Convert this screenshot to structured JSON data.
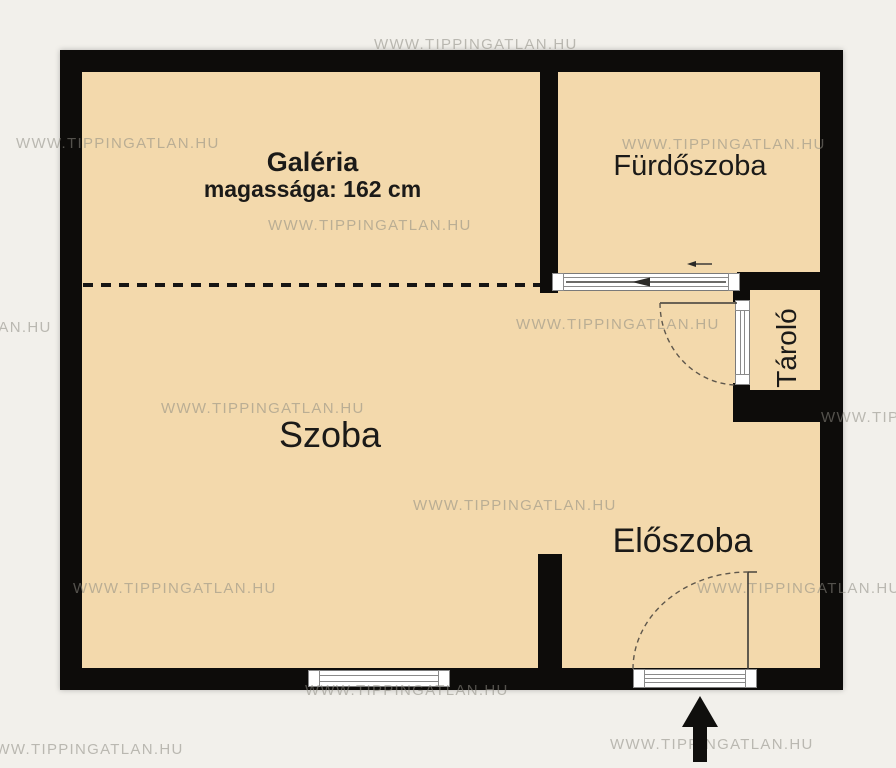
{
  "watermark": {
    "text": "WWW.TIPPINGATLAN.HU"
  },
  "rooms": {
    "galeria": {
      "name": "Galéria",
      "height_note": "magassága: 162 cm"
    },
    "furdoszoba": {
      "name": "Fürdőszoba"
    },
    "szoba": {
      "name": "Szoba"
    },
    "eloszoba": {
      "name": "Előszoba"
    },
    "tarolo": {
      "name": "Tároló"
    }
  },
  "colors": {
    "floor": "#f3d9ac",
    "wall": "#0d0c0a",
    "background": "#f2f0eb",
    "watermark": "#8d8b82"
  },
  "watermarks": [
    {
      "x": 374,
      "y": 36
    },
    {
      "x": 16,
      "y": 135
    },
    {
      "x": 268,
      "y": 217
    },
    {
      "x": 622,
      "y": 136
    },
    {
      "x": -152,
      "y": 319
    },
    {
      "x": 516,
      "y": 316
    },
    {
      "x": 161,
      "y": 400
    },
    {
      "x": 413,
      "y": 497
    },
    {
      "x": 821,
      "y": 409
    },
    {
      "x": 73,
      "y": 580
    },
    {
      "x": 697,
      "y": 580
    },
    {
      "x": 305,
      "y": 682
    },
    {
      "x": 610,
      "y": 736
    },
    {
      "x": -20,
      "y": 741
    }
  ]
}
